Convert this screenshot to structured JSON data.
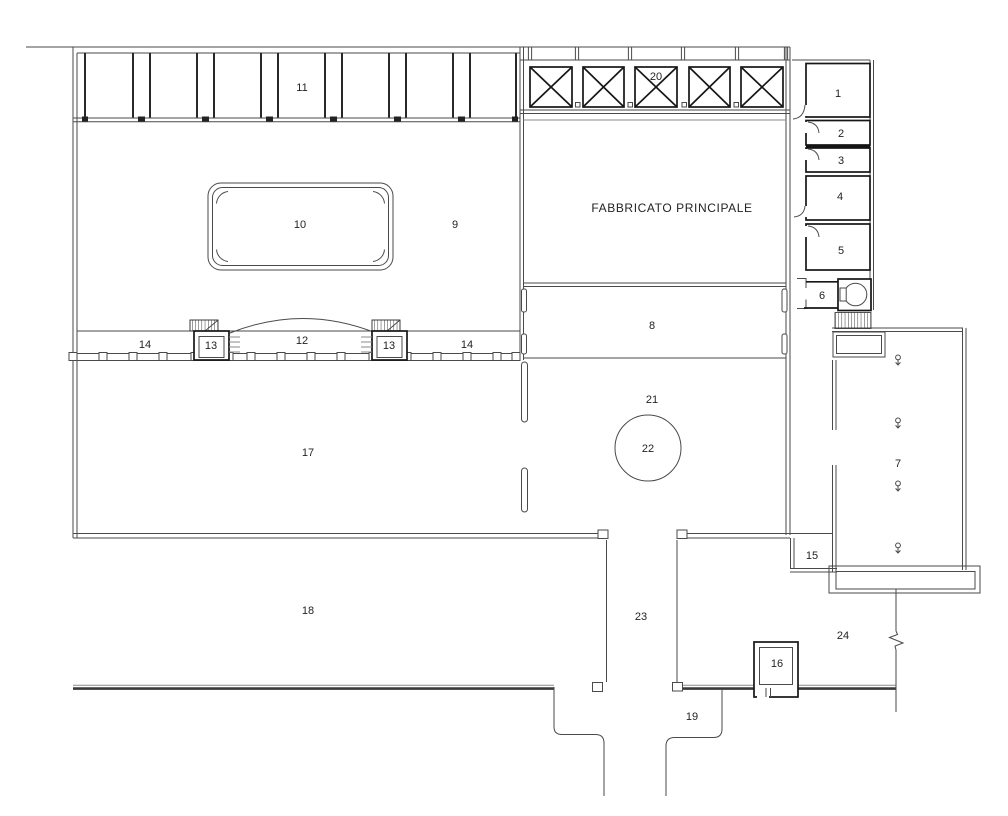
{
  "plan": {
    "building_label": "FABBRICATO PRINCIPALE",
    "labels": {
      "n1": "1",
      "n2": "2",
      "n3": "3",
      "n4": "4",
      "n5": "5",
      "n6": "6",
      "n7": "7",
      "n8": "8",
      "n9": "9",
      "n10": "10",
      "n11": "11",
      "n12": "12",
      "n13a": "13",
      "n13b": "13",
      "n14a": "14",
      "n14b": "14",
      "n15": "15",
      "n16": "16",
      "n17": "17",
      "n18": "18",
      "n19": "19",
      "n20": "20",
      "n21": "21",
      "n22": "22",
      "n23": "23",
      "n24": "24"
    },
    "colors": {
      "background": "#ffffff",
      "wall": "#4a4a4a",
      "wall_dark": "#161616",
      "road": "#3a3a3a",
      "label_text": "#232323"
    }
  }
}
